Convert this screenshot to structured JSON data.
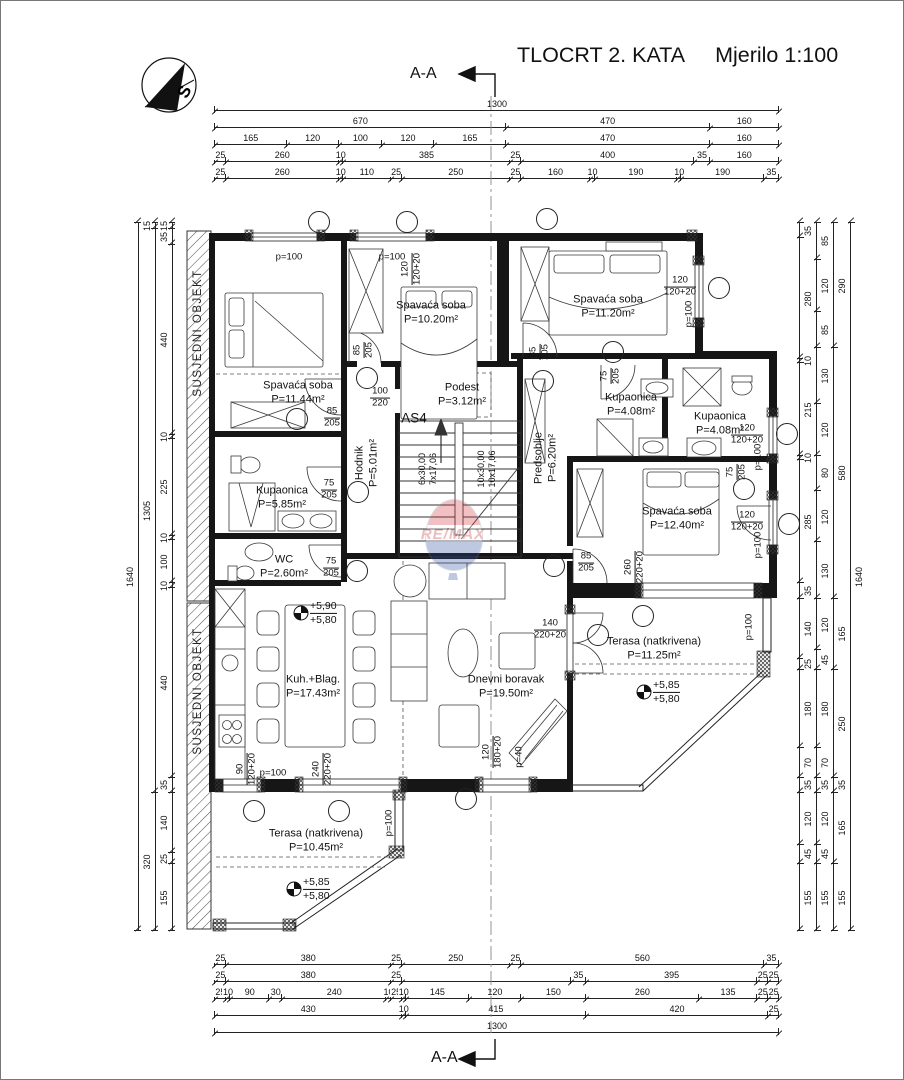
{
  "title": {
    "text": "TLOCRT 2. KATA",
    "scale": "Mjerilo 1:100"
  },
  "section": {
    "top": "A-A",
    "bottom": "A-A"
  },
  "compass": {
    "letter": "S"
  },
  "watermark": {
    "text": "RE/MAX"
  },
  "neighbor_labels": [
    {
      "text": "SUSJEDNI OBJEKT",
      "x": 197,
      "y": 332
    },
    {
      "text": "SUSJEDNI OBJEKT",
      "x": 197,
      "y": 690
    }
  ],
  "rooms": [
    {
      "name": "Spavaća soba",
      "area": "P=11.44m²",
      "x": 297,
      "y": 392
    },
    {
      "name": "Spavaća soba",
      "area": "P=10.20m²",
      "x": 430,
      "y": 312
    },
    {
      "name": "Spavaća soba",
      "area": "P=11.20m²",
      "x": 607,
      "y": 306
    },
    {
      "name": "Kupaonica",
      "area": "P=5.85m²",
      "x": 281,
      "y": 497
    },
    {
      "name": "WC",
      "area": "P=2.60m²",
      "x": 283,
      "y": 566
    },
    {
      "name": "Hodnik",
      "area": "P=5.01m²",
      "x": 366,
      "y": 462,
      "vert": true
    },
    {
      "name": "Podest",
      "area": "P=3.12m²",
      "x": 461,
      "y": 394
    },
    {
      "name": "Predsoblje",
      "area": "P=6.20m²",
      "x": 545,
      "y": 457,
      "vert": true
    },
    {
      "name": "Kupaonica",
      "area": "P=4.08m²",
      "x": 630,
      "y": 404
    },
    {
      "name": "Kupaonica",
      "area": "P=4.08m²",
      "x": 719,
      "y": 423
    },
    {
      "name": "Spavaća soba",
      "area": "P=12.40m²",
      "x": 676,
      "y": 518
    },
    {
      "name": "Kuh.+Blag.",
      "area": "P=17.43m²",
      "x": 312,
      "y": 686
    },
    {
      "name": "Dnevni boravak",
      "area": "P=19.50m²",
      "x": 505,
      "y": 686
    },
    {
      "name": "Terasa (natkrivena)",
      "area": "P=10.45m²",
      "x": 315,
      "y": 840
    },
    {
      "name": "Terasa (natkrivena)",
      "area": "P=11.25m²",
      "x": 653,
      "y": 648
    }
  ],
  "stair_labels": [
    {
      "l1": "6x30,00",
      "l2": "7x17,06",
      "x": 427,
      "y": 468
    },
    {
      "l1": "10x30,00",
      "l2": "10x17,06",
      "x": 486,
      "y": 468
    }
  ],
  "levels": [
    {
      "a": "+5,90",
      "b": "+5,80",
      "x": 300,
      "y": 612
    },
    {
      "a": "+5,85",
      "b": "+5,80",
      "x": 643,
      "y": 691
    },
    {
      "a": "+5,85",
      "b": "+5,80",
      "x": 293,
      "y": 888
    }
  ],
  "open_labels": [
    {
      "t": "120",
      "b": "120+20",
      "x": 411,
      "y": 268,
      "vert": true
    },
    {
      "t": "120",
      "b": "120+20",
      "x": 679,
      "y": 286
    },
    {
      "t": "120",
      "b": "120+20",
      "x": 746,
      "y": 434
    },
    {
      "t": "120",
      "b": "120+20",
      "x": 746,
      "y": 521
    },
    {
      "t": "140",
      "b": "220+20",
      "x": 549,
      "y": 629
    },
    {
      "t": "260",
      "b": "220+20",
      "x": 634,
      "y": 566,
      "vert": true
    },
    {
      "t": "120",
      "b": "180+20",
      "x": 492,
      "y": 751,
      "vert": true
    },
    {
      "t": "90",
      "b": "120+20",
      "x": 246,
      "y": 768,
      "vert": true
    },
    {
      "t": "240",
      "b": "220+20",
      "x": 322,
      "y": 768,
      "vert": true
    },
    {
      "t": "85",
      "b": "205",
      "x": 331,
      "y": 417
    },
    {
      "t": "85",
      "b": "205",
      "x": 363,
      "y": 349,
      "vert": true
    },
    {
      "t": "75",
      "b": "205",
      "x": 328,
      "y": 489
    },
    {
      "t": "75",
      "b": "205",
      "x": 330,
      "y": 567
    },
    {
      "t": "85",
      "b": "205",
      "x": 539,
      "y": 351,
      "vert": true
    },
    {
      "t": "75",
      "b": "205",
      "x": 610,
      "y": 375,
      "vert": true
    },
    {
      "t": "75",
      "b": "205",
      "x": 736,
      "y": 471,
      "vert": true
    },
    {
      "t": "85",
      "b": "205",
      "x": 585,
      "y": 562
    },
    {
      "t": "100",
      "b": "220",
      "x": 379,
      "y": 397
    }
  ],
  "p_labels": [
    {
      "text": "p=100",
      "x": 288,
      "y": 256
    },
    {
      "text": "p=100",
      "x": 391,
      "y": 256
    },
    {
      "text": "p=100",
      "x": 688,
      "y": 313,
      "vert": true
    },
    {
      "text": "p=100",
      "x": 757,
      "y": 456,
      "vert": true
    },
    {
      "text": "p=100",
      "x": 757,
      "y": 544,
      "vert": true
    },
    {
      "text": "p=100",
      "x": 748,
      "y": 626,
      "vert": true
    },
    {
      "text": "p=100",
      "x": 388,
      "y": 822,
      "vert": true
    },
    {
      "text": "p=100",
      "x": 272,
      "y": 772
    },
    {
      "text": "p=40",
      "x": 518,
      "y": 756,
      "vert": true
    },
    {
      "text": "AS4",
      "x": 413,
      "y": 417,
      "big": true
    }
  ],
  "balloons": [
    {
      "x": 318,
      "y": 221
    },
    {
      "x": 406,
      "y": 221
    },
    {
      "x": 546,
      "y": 218
    },
    {
      "x": 718,
      "y": 287
    },
    {
      "x": 786,
      "y": 433
    },
    {
      "x": 788,
      "y": 523
    },
    {
      "x": 296,
      "y": 418
    },
    {
      "x": 366,
      "y": 377
    },
    {
      "x": 357,
      "y": 491
    },
    {
      "x": 356,
      "y": 570
    },
    {
      "x": 542,
      "y": 380
    },
    {
      "x": 612,
      "y": 351
    },
    {
      "x": 743,
      "y": 488
    },
    {
      "x": 553,
      "y": 565
    },
    {
      "x": 597,
      "y": 634
    },
    {
      "x": 642,
      "y": 615
    },
    {
      "x": 253,
      "y": 810
    },
    {
      "x": 338,
      "y": 810
    },
    {
      "x": 465,
      "y": 798
    }
  ],
  "dimensions": {
    "top": [
      [
        1300
      ],
      [
        670,
        470,
        160
      ],
      [
        165,
        120,
        100,
        120,
        165,
        470,
        160
      ],
      [
        25,
        260,
        10,
        385,
        25,
        400,
        35,
        160
      ],
      [
        25,
        260,
        10,
        110,
        25,
        250,
        25,
        160,
        10,
        190,
        10,
        190,
        35
      ]
    ],
    "bottom": [
      [
        25,
        380,
        25,
        250,
        25,
        560,
        35
      ],
      [
        25,
        380,
        25,
        {
          "v": 390,
          "t": ""
        },
        35,
        395,
        25,
        25
      ],
      [
        25,
        10,
        90,
        30,
        240,
        10,
        25,
        10,
        145,
        120,
        150,
        260,
        135,
        25,
        25
      ],
      [
        430,
        10,
        415,
        420,
        25
      ],
      [
        1300
      ]
    ],
    "left": [
      [
        15,
        35,
        440,
        10,
        225,
        10,
        100,
        10,
        440,
        35,
        140,
        25,
        155
      ],
      [
        15,
        1305,
        320
      ],
      [
        1640
      ]
    ],
    "right": [
      [
        35,
        280,
        10,
        215,
        10,
        285,
        35,
        140,
        25,
        180,
        70,
        35,
        120,
        45,
        155
      ],
      [
        85,
        120,
        85,
        130,
        120,
        80,
        120,
        130,
        120,
        45,
        180,
        70,
        35,
        120,
        45,
        155
      ],
      [
        290,
        580,
        165,
        250,
        35,
        165,
        155
      ],
      [
        1640
      ]
    ]
  }
}
